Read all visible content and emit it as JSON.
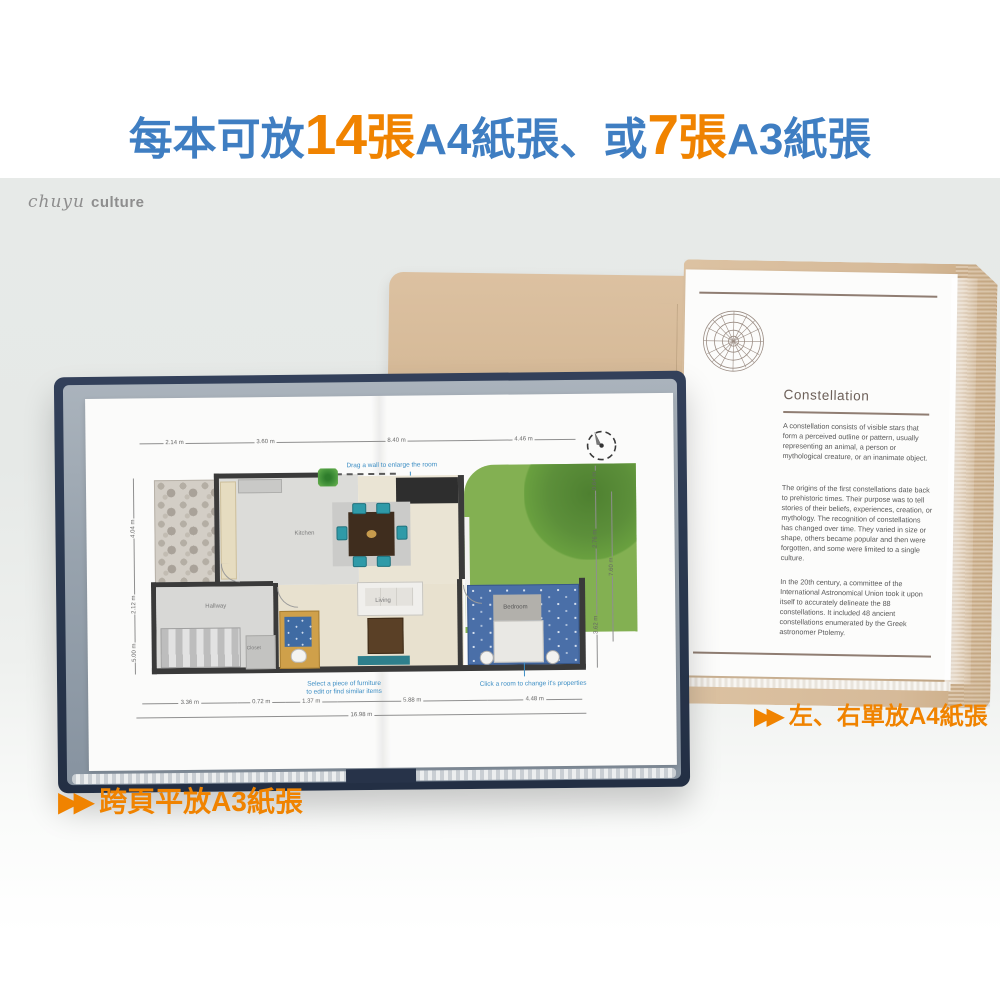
{
  "title": {
    "t1": "每本可放",
    "n1": "14",
    "z1": "張",
    "t2": "A4紙張、或",
    "n2": "7",
    "z2": "張",
    "t3": "A3紙張"
  },
  "brand": {
    "script": "chuyu",
    "word": "culture"
  },
  "captions": {
    "arrows": "▶▶",
    "a3_label": "跨頁平放A3紙張",
    "a4_label": "左、右單放A4紙張"
  },
  "floorplan": {
    "ann_drag": "Drag a wall to enlarge the room",
    "ann_select_1": "Select a piece of furniture",
    "ann_select_2": "to edit or find similar items",
    "ann_click": "Click a room to change it's properties",
    "rooms": {
      "kitchen": "Kitchen",
      "living": "Living",
      "bedroom": "Bedroom",
      "hallway": "Hallway",
      "closet": "Closet"
    },
    "dims_top": [
      "2.14 m",
      "3.60 m",
      "8.40 m",
      "4.46 m"
    ],
    "dims_bottom": [
      "3.36 m",
      "0.72 m",
      "1.37 m",
      "5.88 m",
      "4.48 m"
    ],
    "dim_total": "16.98 m",
    "dims_left": [
      "4.04 m",
      "2.12 m",
      "5.00 m"
    ],
    "dims_right": [
      "0.64 m",
      "2.76 m",
      "3.62 m"
    ],
    "dim_right_outer": "7.60 m"
  },
  "a4_page": {
    "heading": "Constellation",
    "para1": "A constellation consists of visible stars that form a perceived outline or pattern, usually representing an animal, a person or mythological creature, or an inanimate object.",
    "para2": "The origins of the first constellations date back to prehistoric times. Their purpose was to tell stories of their beliefs, experiences, creation, or mythology. The recognition of constellations has changed over time. They varied in size or shape, others became popular and then were forgotten, and some were limited to a single culture.",
    "para3": "In the 20th century, a committee of the International Astronomical Union took it upon itself to accurately delineate the 88 constellations. It included 48 ancient constellations enumerated by the Greek astronomer Ptolemy."
  },
  "colors": {
    "title_blue": "#3f7ec2",
    "accent_orange": "#f08300",
    "navy_cover": "#2b3950",
    "tan_cover": "#d6ba99",
    "lawn_green": "#83b052"
  }
}
